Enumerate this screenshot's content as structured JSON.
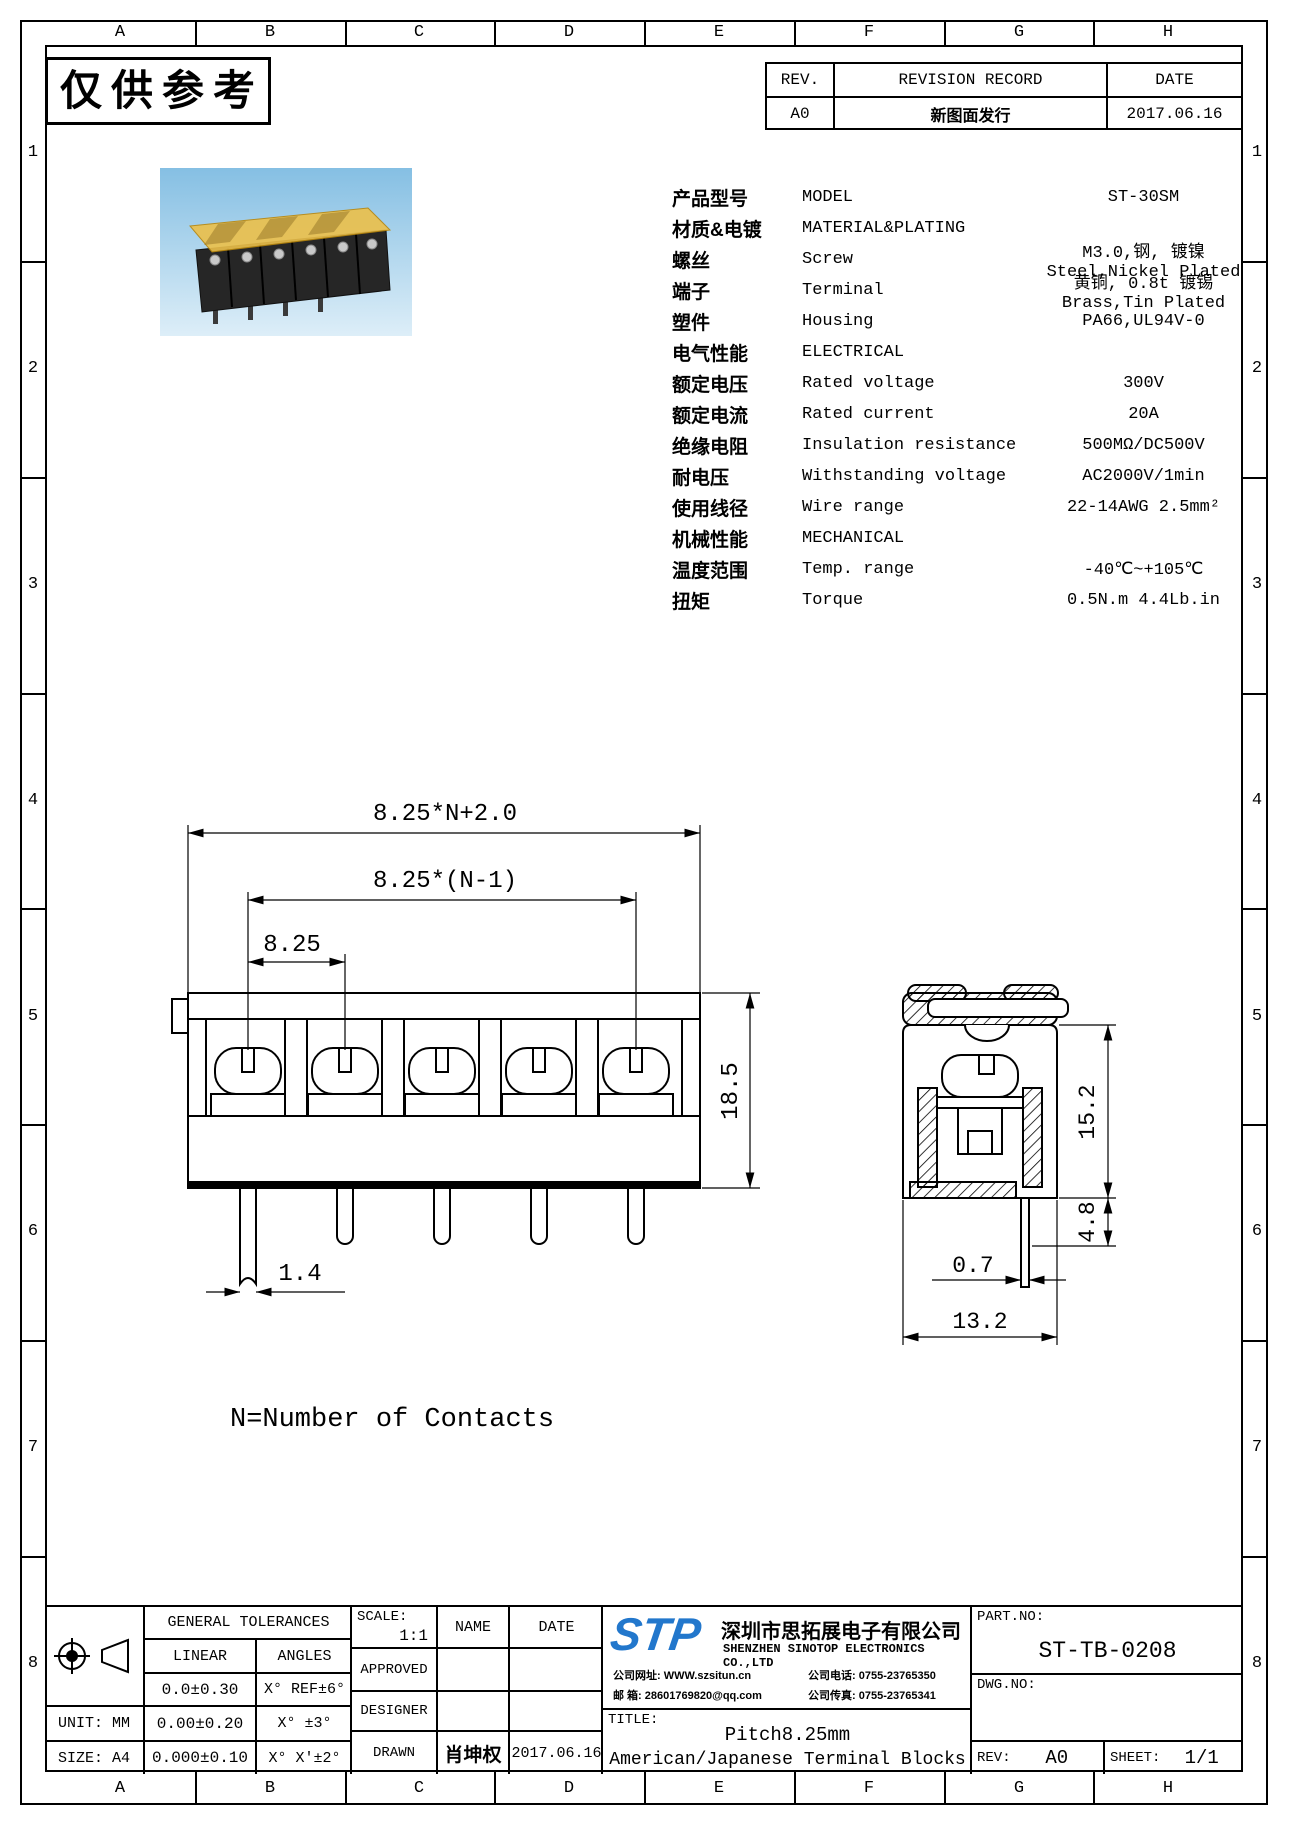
{
  "watermark": "仅供参考",
  "grid": {
    "columns": [
      "A",
      "B",
      "C",
      "D",
      "E",
      "F",
      "G",
      "H"
    ],
    "rows": [
      "1",
      "2",
      "3",
      "4",
      "5",
      "6",
      "7",
      "8"
    ]
  },
  "revision_table": {
    "rev_header": "REV.",
    "record_header": "REVISION RECORD",
    "date_header": "DATE",
    "rows": [
      {
        "rev": "A0",
        "record": "新图面发行",
        "date": "2017.06.16"
      }
    ]
  },
  "specs": {
    "rows": [
      {
        "cn": "产品型号",
        "en": "MODEL",
        "value": "ST-30SM"
      },
      {
        "cn": "材质&电镀",
        "en": "MATERIAL&PLATING",
        "value": ""
      },
      {
        "cn": "螺丝",
        "en": "Screw",
        "value": "M3.0,钢, 镀镍 Steel,Nickel Plated"
      },
      {
        "cn": "端子",
        "en": "Terminal",
        "value": "黄铜, 0.8t 镀锡 Brass,Tin Plated"
      },
      {
        "cn": "塑件",
        "en": "Housing",
        "value": "PA66,UL94V-0"
      },
      {
        "cn": "电气性能",
        "en": "ELECTRICAL",
        "value": ""
      },
      {
        "cn": "额定电压",
        "en": "Rated voltage",
        "value": "300V"
      },
      {
        "cn": "额定电流",
        "en": "Rated current",
        "value": "20A"
      },
      {
        "cn": "绝缘电阻",
        "en": "Insulation resistance",
        "value": "500MΩ/DC500V"
      },
      {
        "cn": "耐电压",
        "en": "Withstanding voltage",
        "value": "AC2000V/1min"
      },
      {
        "cn": "使用线径",
        "en": "Wire range",
        "value": "22-14AWG 2.5mm²"
      },
      {
        "cn": "机械性能",
        "en": "MECHANICAL",
        "value": ""
      },
      {
        "cn": "温度范围",
        "en": "Temp. range",
        "value": "-40℃~+105℃"
      },
      {
        "cn": "扭矩",
        "en": "Torque",
        "value": "0.5N.m 4.4Lb.in"
      }
    ]
  },
  "dimensions": {
    "front": {
      "total": "8.25*N+2.0",
      "span": "8.25*(N-1)",
      "pitch": "8.25",
      "height": "18.5",
      "pin_width": "1.4"
    },
    "side": {
      "height": "15.2",
      "pin_length": "4.8",
      "pin_thickness": "0.7",
      "depth": "13.2"
    },
    "note": "N=Number of Contacts"
  },
  "title_block": {
    "tolerances": {
      "title": "GENERAL TOLERANCES",
      "linear_header": "LINEAR",
      "angles_header": "ANGLES",
      "rows": [
        {
          "linear": "0.0±0.30",
          "angles": "X° REF±6°"
        },
        {
          "linear": "0.00±0.20",
          "angles": "X° ±3°"
        },
        {
          "linear": "0.000±0.10",
          "angles": "X° X'±2°"
        }
      ]
    },
    "unit": "UNIT: MM",
    "size": "SIZE: A4",
    "scale_label": "SCALE:",
    "scale_value": "1:1",
    "name_header": "NAME",
    "date_header": "DATE",
    "approved_label": "APPROVED",
    "designer_label": "DESIGNER",
    "drawn_label": "DRAWN",
    "drawn_name": "肖坤权",
    "drawn_date": "2017.06.16",
    "company": {
      "logo": "STP",
      "name_cn": "深圳市思拓展电子有限公司",
      "name_en": "SHENZHEN SINOTOP ELECTRONICS CO.,LTD",
      "website_label": "公司网址:",
      "website": "WWW.szsitun.cn",
      "email_label": "邮  箱:",
      "email": "28601769820@qq.com",
      "phone_label": "公司电话:",
      "phone": "0755-23765350",
      "fax_label": "公司传真:",
      "fax": "0755-23765341"
    },
    "title_label": "TITLE:",
    "title_line1": "Pitch8.25mm",
    "title_line2": "American/Japanese Terminal Blocks",
    "part_no_label": "PART.NO:",
    "part_no": "ST-TB-0208",
    "dwg_no_label": "DWG.NO:",
    "rev_label": "REV:",
    "rev": "A0",
    "sheet_label": "SHEET:",
    "sheet": "1/1"
  },
  "colors": {
    "line": "#000000",
    "logo_blue": "#2277cc",
    "photo_sky_top": "#85bfe3",
    "photo_sky_bottom": "#ddeef8",
    "cover_amber": "#ecc04a",
    "cover_edge": "#b8860b",
    "block_dark": "#262626"
  }
}
